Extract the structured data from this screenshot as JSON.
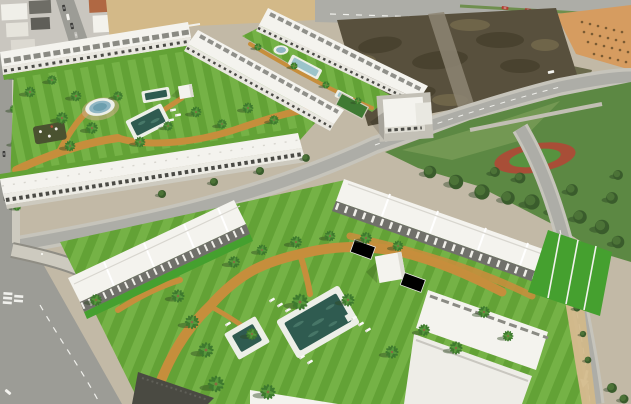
{
  "meta": {
    "type": "aerial-photograph",
    "description": "Aerial drone render of a Mediterranean residential development: white apartment and townhouse blocks around landscaped green courtyards with swimming pools, an oval pond, ochre walking paths and palm trees; surrounded by roads, an older town block at top left, a vacant dirt lot at top right, an orchard field, and a public park with an oval playground track.",
    "width": 631,
    "height": 404
  },
  "colors": {
    "baseGround": "#c2b9a6",
    "townBlock": "#c9c6bf",
    "building": "#f4f3ee",
    "buildingShade": "#dddbd2",
    "facade": "#e9e7e0",
    "pergola": "#70706a",
    "grass": "#63a236",
    "grassLight": "#75b246",
    "yardGreen": "#45a02f",
    "parkGreen": "#5c8843",
    "poolDeck": "#edefe8",
    "poolWater": "#2f5b50",
    "lanePoolWater": "#9cc4ca",
    "pondWater": "#8fb6c3",
    "dirtLot": "#58503d",
    "sand": "#d3b988",
    "orchardSand": "#d69c60",
    "scrub": "#6b6a4c",
    "road": "#adada7",
    "roadDark": "#9c9c96",
    "roadEdge": "#c6c4bb",
    "sidewalk": "#cdcabf",
    "ochrePath": "#c68e3c",
    "window": "#4a4a45",
    "marking": "#f0f0ec",
    "playgroundClay": "#a84e37",
    "playgroundCore": "#57923f",
    "treeDark": "#3a5c2c",
    "treeLight": "#4c7337",
    "palmFrond": "#3e7a2e",
    "palmFrondLight": "#57993c",
    "carRed": "#b33a2e",
    "carDark": "#3a3a38",
    "carWhite": "#f2f1ec",
    "shadow": "#1e2a16"
  }
}
